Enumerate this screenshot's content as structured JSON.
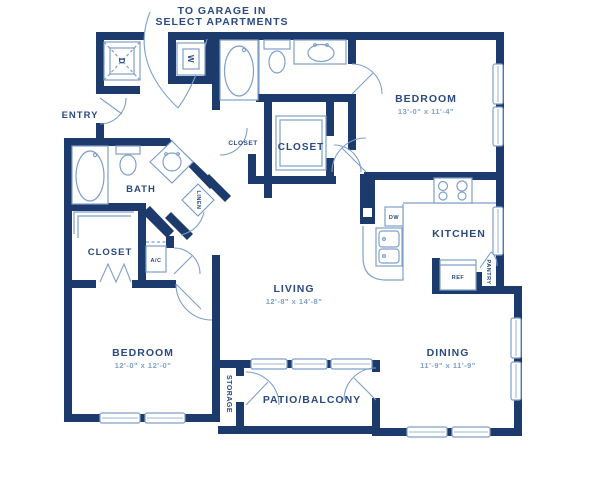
{
  "note": {
    "line1": "TO GARAGE IN",
    "line2": "SELECT APARTMENTS"
  },
  "colors": {
    "wall": "#1c3a6b",
    "fixture": "#7f9fc9",
    "label": "#2a4a80",
    "dimension": "#7f9fc9",
    "background": "#ffffff"
  },
  "rooms": {
    "bedroom_top": {
      "name": "BEDROOM",
      "dims": "13'-0\" x 11'-4\""
    },
    "bedroom_bottom": {
      "name": "BEDROOM",
      "dims": "12'-0\" x 12'-0\""
    },
    "living": {
      "name": "LIVING",
      "dims": "12'-8\" x 14'-8\""
    },
    "dining": {
      "name": "DINING",
      "dims": "11'-9\" x 11'-9\""
    },
    "kitchen": {
      "name": "KITCHEN"
    },
    "bath": {
      "name": "BATH"
    },
    "entry": {
      "name": "ENTRY"
    },
    "patio": {
      "name": "PATIO/BALCONY"
    },
    "storage": {
      "name": "STORAGE"
    },
    "linen": {
      "name": "LINEN"
    },
    "closet_bedroom": {
      "name": "CLOSET"
    },
    "closet_hall_small": {
      "name": "CLOSET"
    },
    "closet_hall_large": {
      "name": "CLOSET"
    }
  },
  "appliances": {
    "washer": "W",
    "dryer": "D",
    "dishwasher": "DW",
    "refrigerator": "REF",
    "pantry": "PANTRY",
    "ac_unit": "A/C"
  }
}
